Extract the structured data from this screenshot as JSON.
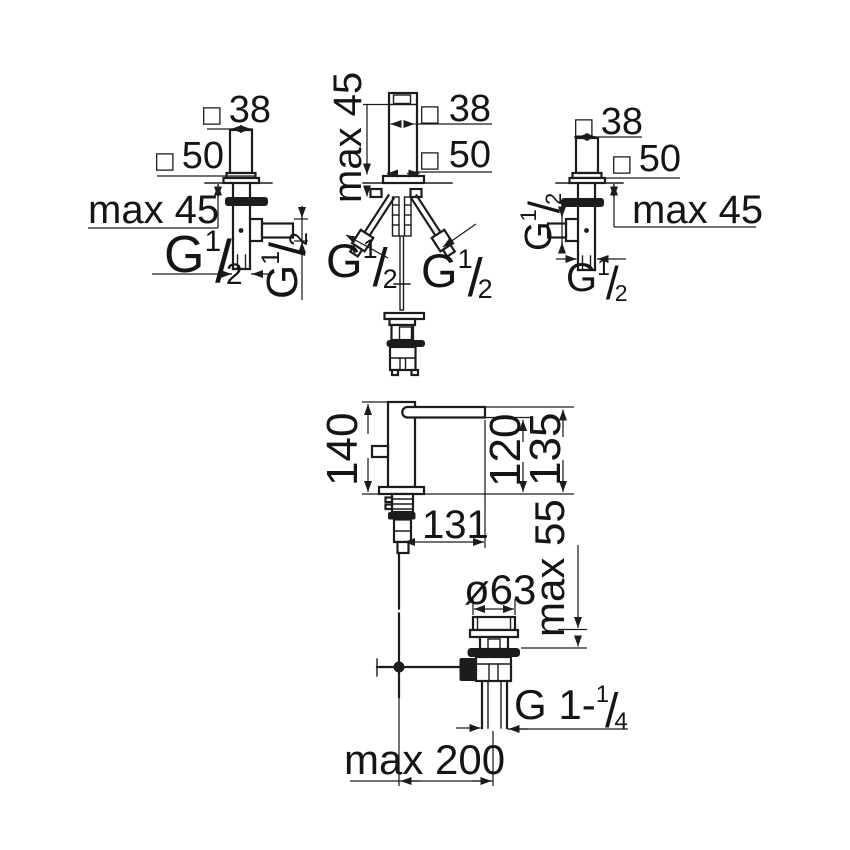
{
  "drawing": {
    "dims": {
      "square38": {
        "symbol": "□",
        "value": "38"
      },
      "square50": {
        "symbol": "□",
        "value": "50"
      },
      "max_deck_thickness": "max 45",
      "g_half": {
        "base": "G",
        "numerator": "1",
        "slash": "/",
        "denominator": "2"
      },
      "height_140": "140",
      "height_135": "135",
      "height_120": "120",
      "reach_131": "131",
      "max_basin_thickness": "max 55",
      "waste_diameter": "ø63",
      "g_one_quarter": {
        "base": "G 1-",
        "numerator": "1",
        "slash": "/",
        "denominator": "4"
      },
      "max_rod_distance": "max 200"
    }
  }
}
